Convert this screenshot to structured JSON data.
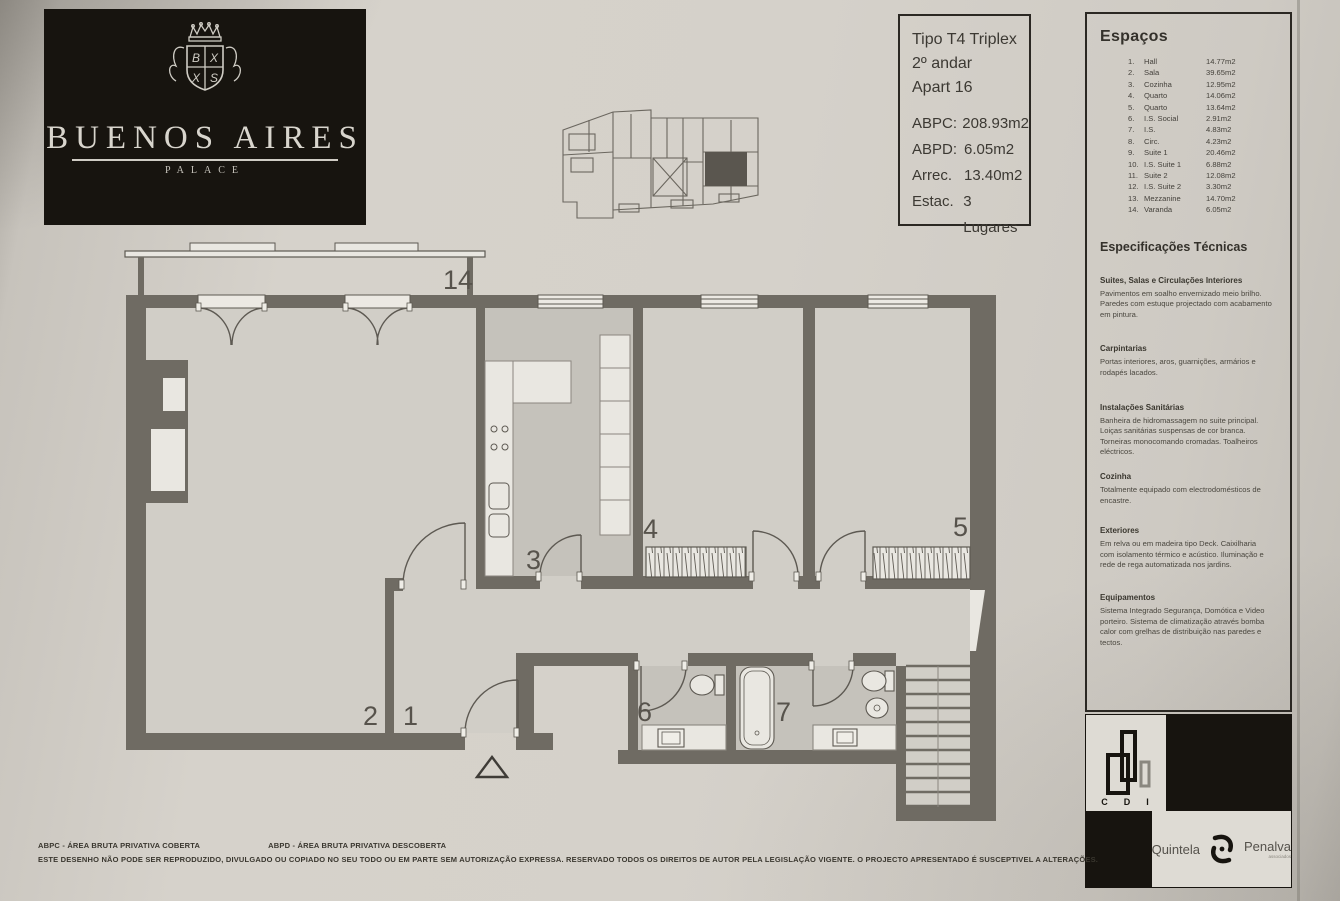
{
  "logo": {
    "name": "BUENOS AIRES",
    "sub": "PALACE"
  },
  "title_block": {
    "type": "Tipo T4 Triplex",
    "floor": "2º andar",
    "apartment": "Apart 16",
    "metrics": [
      {
        "label": "ABPC:",
        "value": "208.93m2"
      },
      {
        "label": "ABPD:",
        "value": "6.05m2"
      },
      {
        "label": "Arrec.",
        "value": "13.40m2"
      },
      {
        "label": "Estac.",
        "value": "3 Lugares"
      }
    ]
  },
  "espacos": {
    "heading": "Espaços",
    "items": [
      {
        "num": "1.",
        "label": "Hall",
        "area": "14.77m2"
      },
      {
        "num": "2.",
        "label": "Sala",
        "area": "39.65m2"
      },
      {
        "num": "3.",
        "label": "Cozinha",
        "area": "12.95m2"
      },
      {
        "num": "4.",
        "label": "Quarto",
        "area": "14.06m2"
      },
      {
        "num": "5.",
        "label": "Quarto",
        "area": "13.64m2"
      },
      {
        "num": "6.",
        "label": "I.S. Social",
        "area": "2.91m2"
      },
      {
        "num": "7.",
        "label": "I.S.",
        "area": "4.83m2"
      },
      {
        "num": "8.",
        "label": "Circ.",
        "area": "4.23m2"
      },
      {
        "num": "9.",
        "label": "Suite 1",
        "area": "20.46m2"
      },
      {
        "num": "10.",
        "label": "I.S. Suite 1",
        "area": "6.88m2"
      },
      {
        "num": "11.",
        "label": "Suite 2",
        "area": "12.08m2"
      },
      {
        "num": "12.",
        "label": "I.S. Suite 2",
        "area": "3.30m2"
      },
      {
        "num": "13.",
        "label": "Mezzanine",
        "area": "14.70m2"
      },
      {
        "num": "14.",
        "label": "Varanda",
        "area": "6.05m2"
      }
    ]
  },
  "specs": {
    "heading": "Especificações Técnicas",
    "sections": [
      {
        "title": "Suites, Salas e Circulações Interiores",
        "body": "Pavimentos em soalho envernizado meio brilho. Paredes com estuque projectado com acabamento em pintura."
      },
      {
        "title": "Carpintarias",
        "body": "Portas interiores, aros, guarnições, armários e rodapés lacados."
      },
      {
        "title": "Instalações Sanitárias",
        "body": "Banheira de hidromassagem no suite principal. Loiças sanitárias suspensas de cor branca. Torneiras monocomando cromadas. Toalheiros eléctricos."
      },
      {
        "title": "Cozinha",
        "body": "Totalmente equipado com electrodomésticos de encastre."
      },
      {
        "title": "Exteriores",
        "body": "Em relva ou em madeira tipo Deck. Caixilharia com isolamento térmico e acústico. Iluminação e rede de rega automatizada nos jardins."
      },
      {
        "title": "Equipamentos",
        "body": "Sistema Integrado Segurança, Domótica e Video porteiro. Sistema de climatização através bomba calor com grelhas de distribuição nas paredes e tectos."
      }
    ]
  },
  "plan": {
    "labels": {
      "balcony": "14",
      "sala": "2",
      "hall": "1",
      "cozinha": "3",
      "quarto4": "4",
      "quarto5": "5",
      "is_social": "6",
      "is7": "7"
    }
  },
  "brands": {
    "cdi": {
      "letters": "CDI"
    },
    "qp": {
      "left": "Quintela",
      "right": "Penalva",
      "sub": "associados"
    }
  },
  "footer": {
    "abbr1": "ABPC - ÁREA BRUTA PRIVATIVA COBERTA",
    "abbr2": "ABPD - ÁREA BRUTA PRIVATIVA DESCOBERTA",
    "legal": "ESTE DESENHO NÃO PODE SER REPRODUZIDO, DIVULGADO OU COPIADO NO SEU TODO OU EM PARTE SEM AUTORIZAÇÃO EXPRESSA. RESERVADO TODOS OS DIREITOS DE AUTOR PELA LEGISLAÇÃO VIGENTE. O PROJECTO APRESENTADO É SUSCEPTIVEL A ALTERAÇÕES."
  },
  "colors": {
    "wall": "#6f6b63",
    "paper": "#d5d1ca",
    "ink": "#3d3a34",
    "logo_bg": "#17140f"
  }
}
